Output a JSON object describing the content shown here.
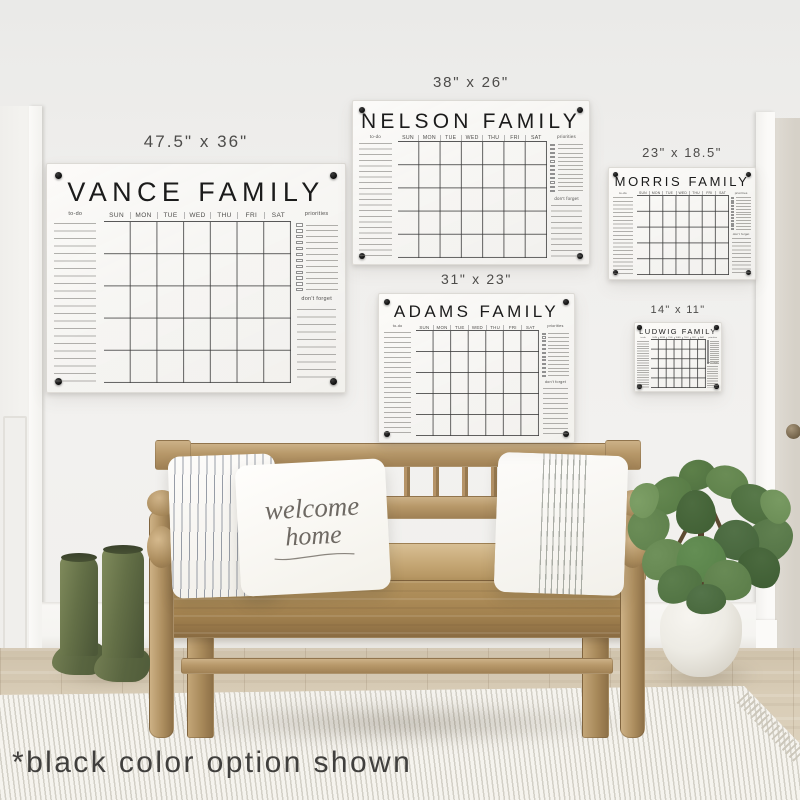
{
  "footnote": "*black color option shown",
  "calendar_common": {
    "todo_label": "to-do",
    "priorities_label": "priorities",
    "dont_forget_label": "don't forget",
    "days": [
      "SUN",
      "MON",
      "TUE",
      "WED",
      "THU",
      "FRI",
      "SAT"
    ]
  },
  "calendars": [
    {
      "name": "VANCE FAMILY",
      "size_label": "47.5\" x 36\""
    },
    {
      "name": "NELSON FAMILY",
      "size_label": "38\" x 26\""
    },
    {
      "name": "MORRIS FAMILY",
      "size_label": "23\" x 18.5\""
    },
    {
      "name": "ADAMS FAMILY",
      "size_label": "31\" x 23\""
    },
    {
      "name": "LUDWIG FAMILY",
      "size_label": "14\" x 11\""
    }
  ],
  "pillow": {
    "line1": "welcome",
    "line2": "home"
  },
  "colors": {
    "marker_black": "#1b1b1b",
    "wall": "#f0efed",
    "bench_wood": "#b5956a",
    "floor_wood": "#d5c8b2",
    "boots_green": "#5f6b44",
    "plant_green": "#4c6a3a",
    "rug": "#e9e7e0"
  }
}
